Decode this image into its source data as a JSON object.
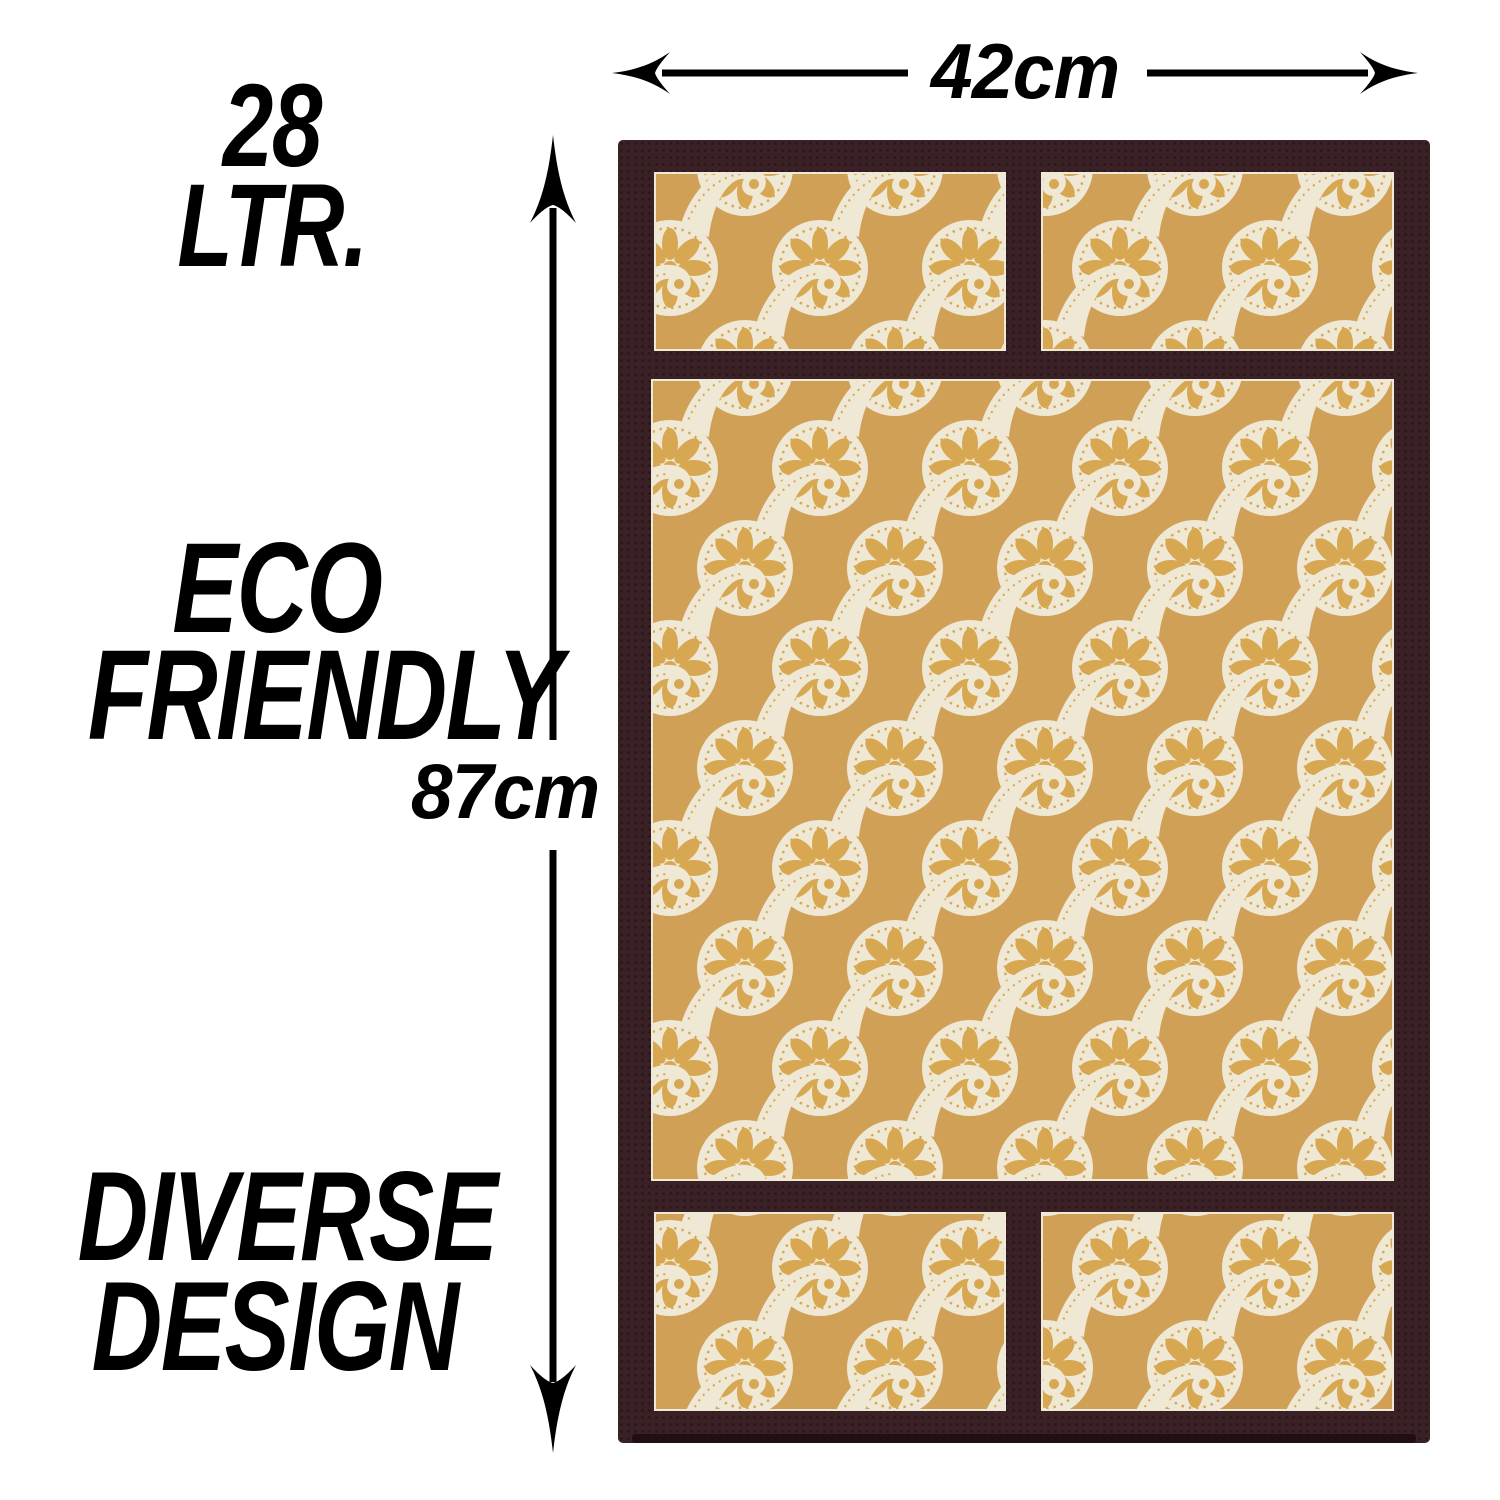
{
  "badges": {
    "capacity": {
      "line1": "28",
      "line2": "LTR."
    },
    "eco": {
      "line1": "ECO",
      "line2": "FRIENDLY"
    },
    "design": {
      "line1": "DIVERSE",
      "line2": "DESIGN"
    }
  },
  "dimensions": {
    "width_label": "42cm",
    "height_label": "87cm"
  },
  "icons": {
    "width_arrow": "double-headed-horizontal-arrow",
    "height_arrow": "double-headed-vertical-arrow"
  },
  "product": {
    "description": "fridge top cover with cream paisley print panels and dark brown fabric border",
    "panels": [
      "top-left",
      "top-right",
      "middle",
      "bottom-left",
      "bottom-right"
    ],
    "colors": {
      "pattern_background": "#d0a057",
      "paisley_cream": "#eee8d5",
      "motif_gold": "#d7a751",
      "border_brown": "#3a2125",
      "border_dot": "#29141a",
      "annotation_black": "#000000"
    }
  }
}
